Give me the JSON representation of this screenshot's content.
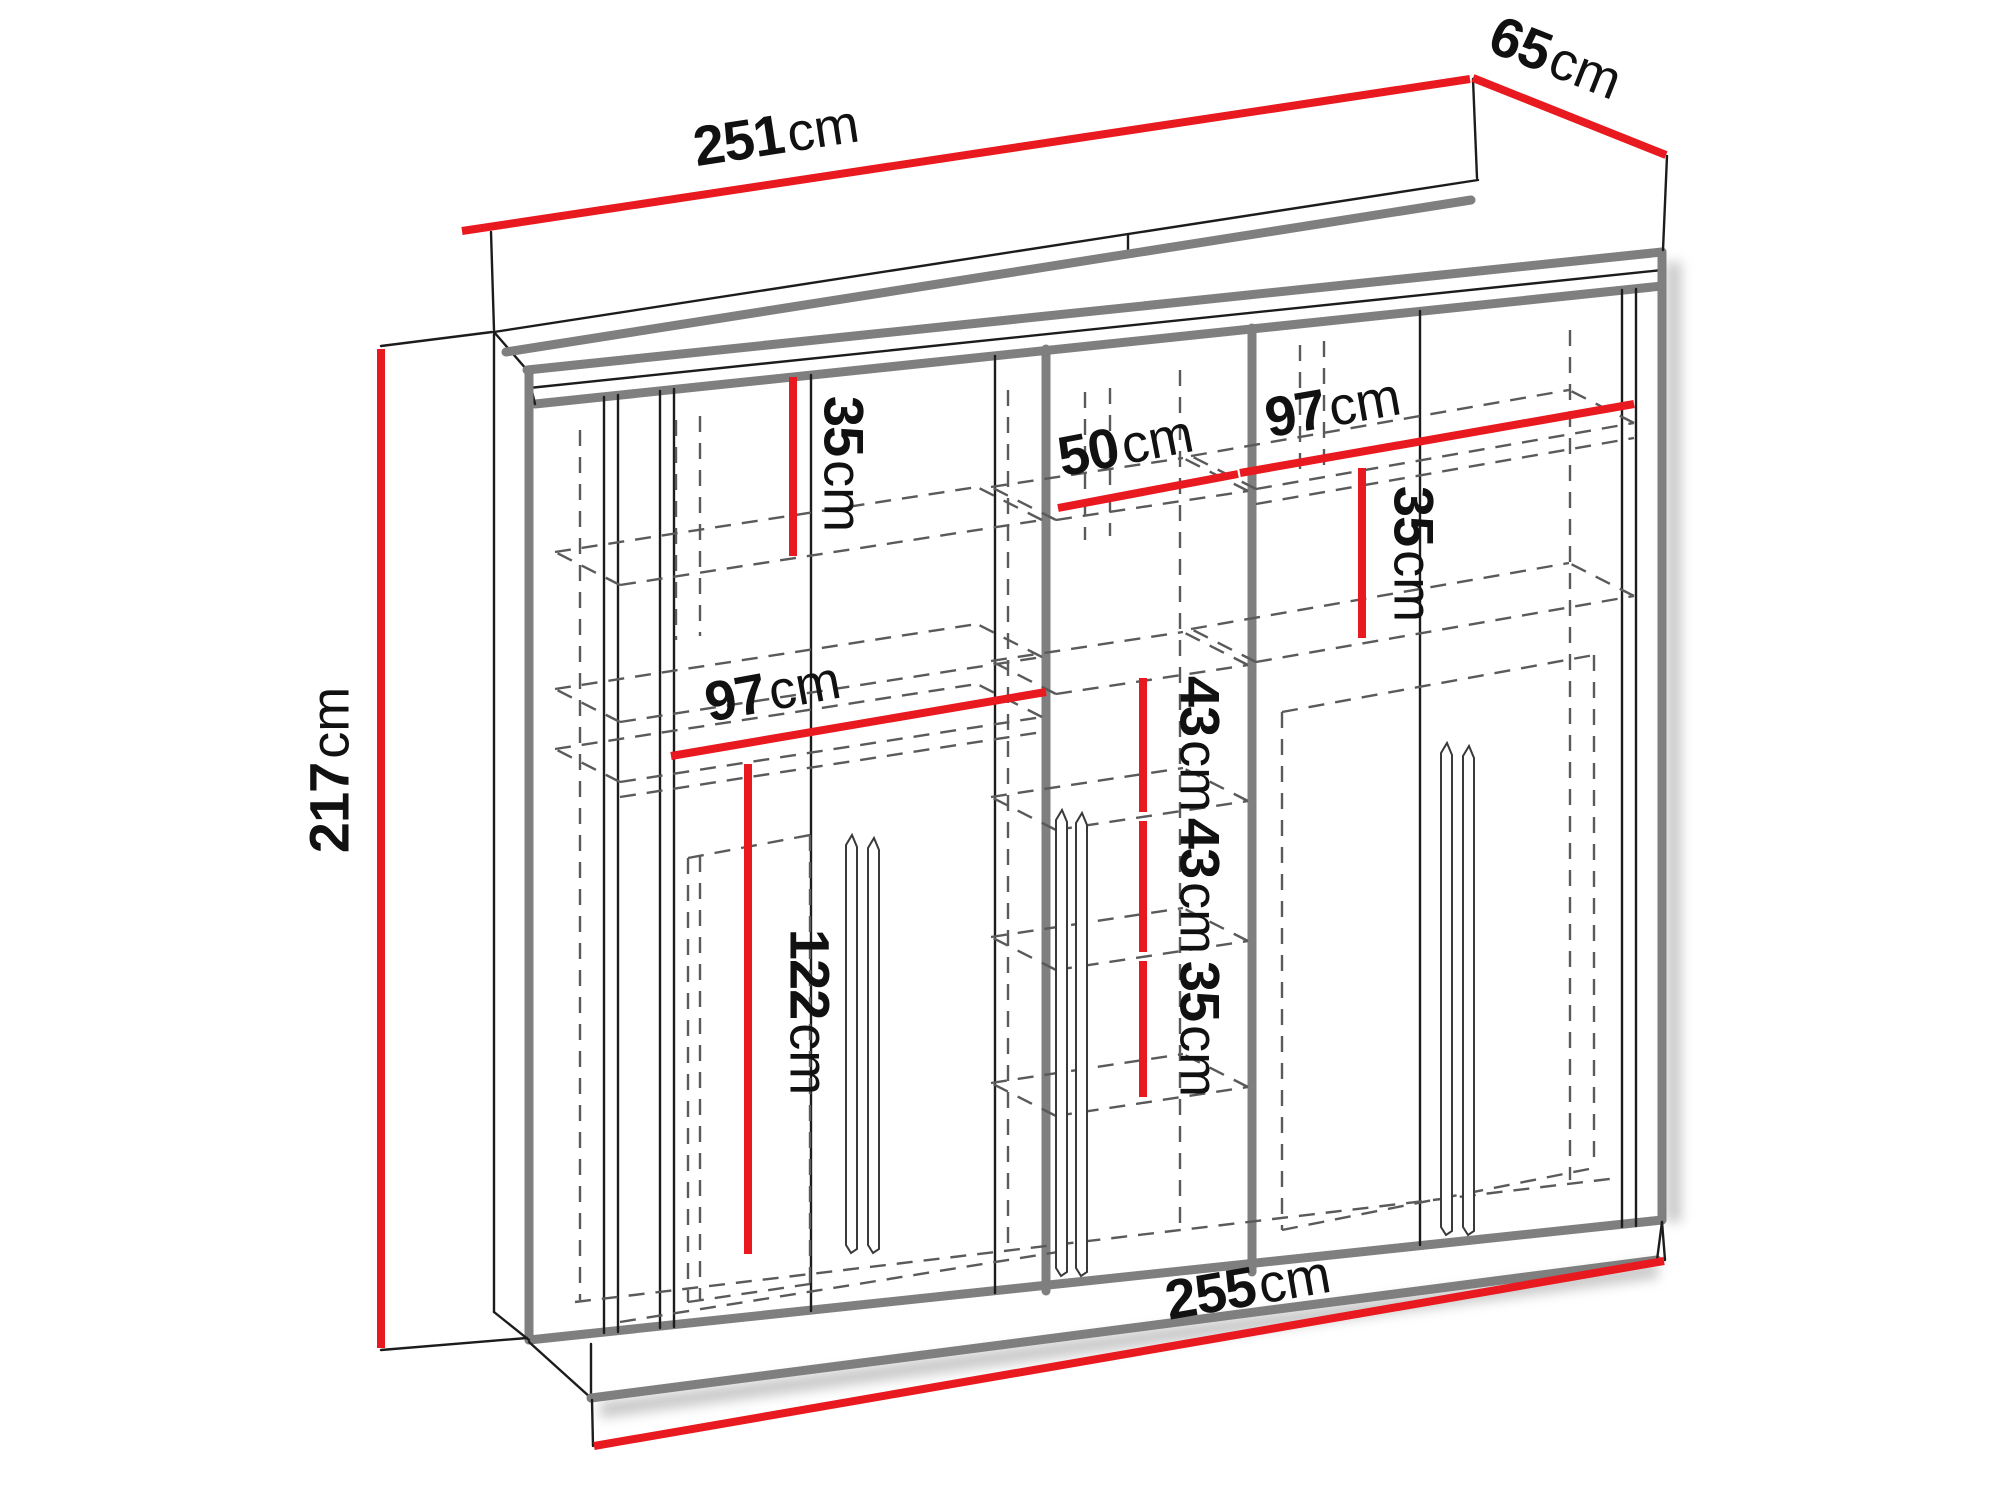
{
  "diagram": {
    "type": "furniture-dimension-drawing",
    "subject": "wardrobe with sliding doors, shelves and hanging sections",
    "unit": "cm",
    "colors": {
      "dimension_line": "#e8191f",
      "outline": "#1c1c1c",
      "panel_edge": "#7f7f7f",
      "hidden_line": "#5a5a5a",
      "label_text": "#111111",
      "background": "#ffffff"
    },
    "overall_dimensions": {
      "width_top_cm": 251,
      "depth_cm": 65,
      "height_cm": 217,
      "width_bottom_cm": 255
    },
    "dimensions": [
      {
        "name": "width-top",
        "value": "251",
        "unit": "cm",
        "line": [
          462,
          231,
          1470,
          79
        ],
        "label": [
          778,
          148
        ],
        "rotate": -8.7
      },
      {
        "name": "depth",
        "value": "65",
        "unit": "cm",
        "line": [
          1473,
          78,
          1666,
          155
        ],
        "label": [
          1551,
          70
        ],
        "rotate": 21.5
      },
      {
        "name": "height",
        "value": "217",
        "unit": "cm",
        "line": [
          381,
          349,
          381,
          1348
        ],
        "label": [
          343,
          770
        ],
        "rotate": -90
      },
      {
        "name": "width-bottom",
        "value": "255",
        "unit": "cm",
        "line": [
          594,
          1446,
          1664,
          1261
        ],
        "label": [
          1250,
          1300
        ],
        "rotate": -9.9
      },
      {
        "name": "top-left-shelf-gap",
        "value": "35",
        "unit": "cm",
        "line": [
          793,
          377,
          793,
          556
        ],
        "label": [
          830,
          464
        ],
        "rotate": 90
      },
      {
        "name": "middle-section-width",
        "value": "50",
        "unit": "cm",
        "line": [
          1058,
          508,
          1238,
          474
        ],
        "label": [
          1128,
          458
        ],
        "rotate": -11
      },
      {
        "name": "right-section-width",
        "value": "97",
        "unit": "cm",
        "line": [
          1240,
          473,
          1634,
          404
        ],
        "label": [
          1335,
          420
        ],
        "rotate": -10
      },
      {
        "name": "right-shelf-gap",
        "value": "35",
        "unit": "cm",
        "line": [
          1362,
          468,
          1362,
          638
        ],
        "label": [
          1400,
          554
        ],
        "rotate": 90
      },
      {
        "name": "left-section-width",
        "value": "97",
        "unit": "cm",
        "line": [
          671,
          756,
          1046,
          692
        ],
        "label": [
          775,
          704
        ],
        "rotate": -10.5
      },
      {
        "name": "hanging-space-height",
        "value": "122",
        "unit": "cm",
        "line": [
          748,
          764,
          748,
          1254
        ],
        "label": [
          796,
          1012
        ],
        "rotate": 90
      },
      {
        "name": "middle-shelf-gap-1",
        "value": "43",
        "unit": "cm",
        "line": [
          1143,
          678,
          1143,
          812
        ],
        "label": [
          1186,
          744
        ],
        "rotate": 90
      },
      {
        "name": "middle-shelf-gap-2",
        "value": "43",
        "unit": "cm",
        "line": [
          1143,
          821,
          1143,
          952
        ],
        "label": [
          1186,
          886
        ],
        "rotate": 90
      },
      {
        "name": "middle-shelf-gap-3",
        "value": "35",
        "unit": "cm",
        "line": [
          1143,
          961,
          1143,
          1097
        ],
        "label": [
          1186,
          1029
        ],
        "rotate": 90
      }
    ]
  }
}
